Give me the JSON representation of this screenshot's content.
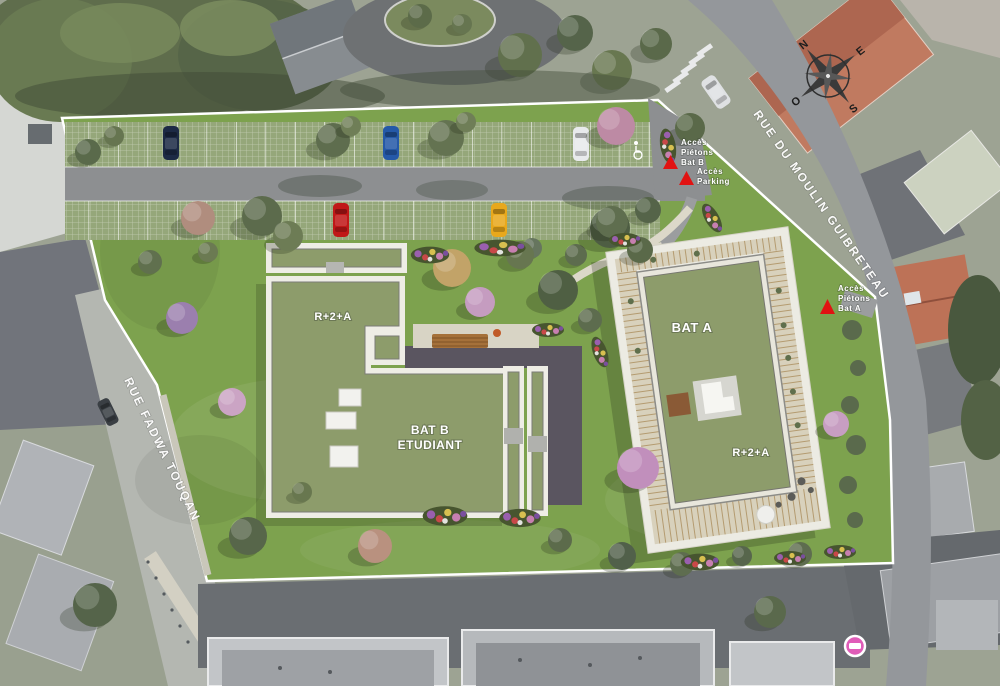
{
  "buildings": {
    "bat_a": "BAT A",
    "bat_a_floors": "R+2+A",
    "bat_b_line1": "BAT B",
    "bat_b_line2": "ETUDIANT",
    "bat_b_floors": "R+2+A"
  },
  "streets": {
    "moulin": "RUE DU MOULIN GUIBRETEAU",
    "fadwa": "RUE FADWA TOUQAN"
  },
  "access": {
    "bat_b": [
      "Accès",
      "Piétons",
      "Bat B"
    ],
    "parking": [
      "Accès",
      "Parking"
    ],
    "bat_a": [
      "Accès",
      "Piétons",
      "Bat A"
    ]
  },
  "compass": {
    "north": "N",
    "east": "E",
    "south": "S",
    "west": "O"
  },
  "colors": {
    "access_red": "#e11212",
    "roof_green": "#8d9c6b",
    "lawn_green": "#7da24e",
    "gravel_white": "#eeede5",
    "marker_pink": "#e05cb8",
    "asphalt": "#8d8f91",
    "dark_paving": "#5a5560",
    "label_white": "#ffffff"
  }
}
